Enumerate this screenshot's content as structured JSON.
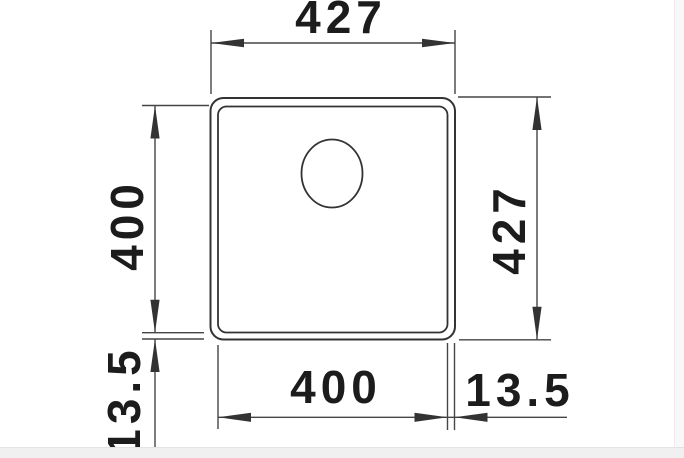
{
  "drawing": {
    "title": "sink-cutout-dimension-drawing",
    "labels": {
      "top_width": "427",
      "left_inner_height": "400",
      "right_outer_height": "427",
      "bottom_inner_width": "400",
      "rim_right": "13.5",
      "rim_left": "13.5"
    },
    "colors": {
      "outline": "#333333",
      "dimension_lines": "#454545",
      "text": "#1c1c1c",
      "background": "#ffffff",
      "margin_band": "#f0f0f0"
    }
  }
}
